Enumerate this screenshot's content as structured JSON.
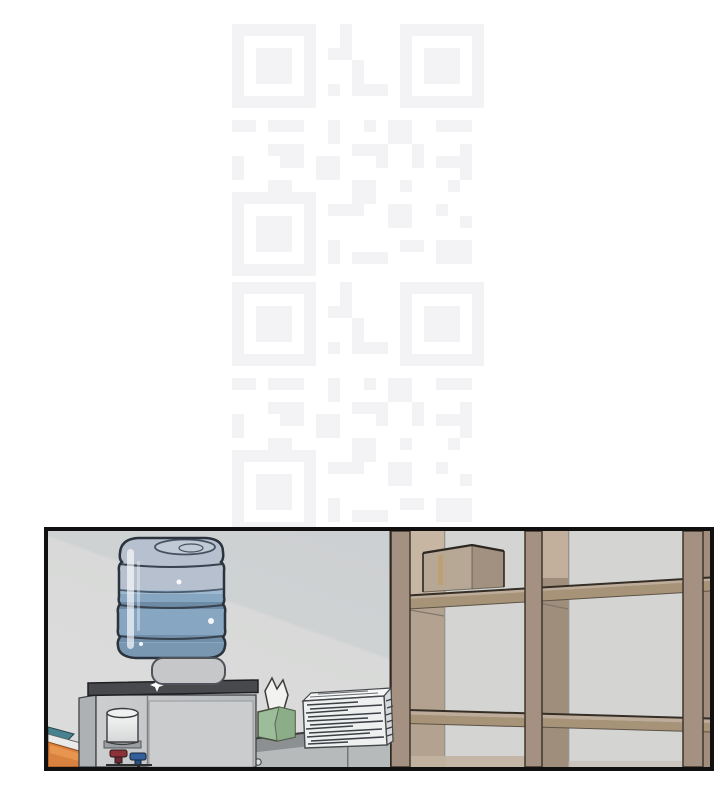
{
  "page": {
    "type": "comic-page",
    "background_color": "#ffffff",
    "label": "manhwa page segment with one illustrated panel at the bottom"
  },
  "watermark": {
    "type": "qr-code-pattern",
    "label": "faint tiled QR-code watermark",
    "color": "#f3f3f5",
    "tile_count": 2
  },
  "panel": {
    "label": "office break-area interior scene",
    "border_color": "#101010",
    "objects": {
      "wall": {
        "label": "office wall with diagonal light",
        "color_light": "#dadbda",
        "color_shadow": "#cdd0d2"
      },
      "water_bottle": {
        "label": "blue water-cooler bottle",
        "water_color": "#87a6c1",
        "empty_color": "#b6c0cf"
      },
      "water_cooler": {
        "label": "water dispenser unit",
        "body_color": "#c4c6c8",
        "top_color": "#47494d"
      },
      "cup_dispenser": {
        "label": "paper-cup dispenser",
        "color": "#f0f1f1"
      },
      "hot_tap": {
        "label": "hot water tap",
        "color": "#8e3038"
      },
      "cold_tap": {
        "label": "cold water tap",
        "color": "#31609a"
      },
      "tissue_box": {
        "label": "green tissue box with tissue",
        "color": "#9dbd9a"
      },
      "paper_stack": {
        "label": "stack of printed papers",
        "color": "#eef0f0"
      },
      "desk": {
        "label": "low gray cabinet desk",
        "top_color": "#8c9093",
        "front_color": "#b7baba"
      },
      "shelf_unit": {
        "label": "wooden cubby shelf unit",
        "frame_color": "#a59181",
        "back_color": "#d4d5d3"
      },
      "cardboard_box": {
        "label": "cardboard box on shelf",
        "color": "#b7a795"
      },
      "leaning_boards": {
        "label": "boards leaning in the corner",
        "colors": [
          "#47828f",
          "#e9eaea",
          "#d9813f"
        ]
      }
    }
  }
}
